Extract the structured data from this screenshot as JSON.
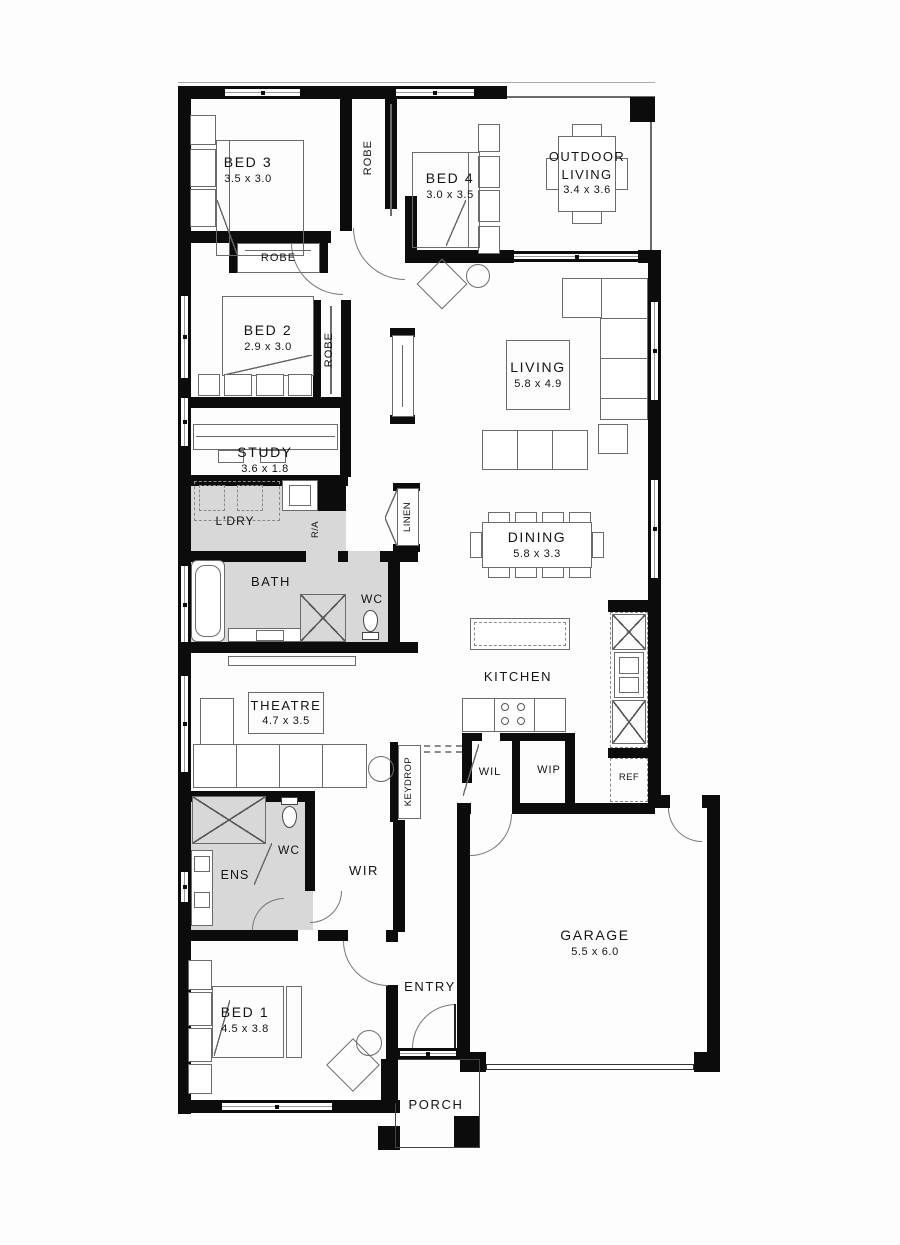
{
  "plan": {
    "labels": {
      "bed3_name": "BED 3",
      "bed3_dims": "3.5 x 3.0",
      "bed4_name": "BED 4",
      "bed4_dims": "3.0 x 3.5",
      "outdoor_name": "OUTDOOR LIVING",
      "outdoor_dims": "3.4 x 3.6",
      "bed2_name": "BED 2",
      "bed2_dims": "2.9 x 3.0",
      "study_name": "STUDY",
      "study_dims": "3.6 x 1.8",
      "living_name": "LIVING",
      "living_dims": "5.8 x 4.9",
      "dining_name": "DINING",
      "dining_dims": "5.8 x 3.3",
      "theatre_name": "THEATRE",
      "theatre_dims": "4.7 x 3.5",
      "garage_name": "GARAGE",
      "garage_dims": "5.5 x 6.0",
      "bed1_name": "BED 1",
      "bed1_dims": "4.5 x 3.8",
      "ldry": "L'DRY",
      "bath": "BATH",
      "wc_main": "WC",
      "kitchen": "KITCHEN",
      "wil": "WIL",
      "wip": "WIP",
      "ref": "REF",
      "wc_ens": "WC",
      "ens": "ENS",
      "wir": "WIR",
      "entry": "ENTRY",
      "porch": "PORCH",
      "robe_top": "ROBE",
      "robe_bed3": "ROBE",
      "robe_bed2": "ROBE",
      "linen": "LINEN",
      "keydrop": "KEYDROP",
      "ra": "R/A"
    },
    "colors": {
      "wall": "#0c0c0c",
      "shading": "#d8d8d8",
      "furniture_line": "#6b6b6b"
    }
  }
}
